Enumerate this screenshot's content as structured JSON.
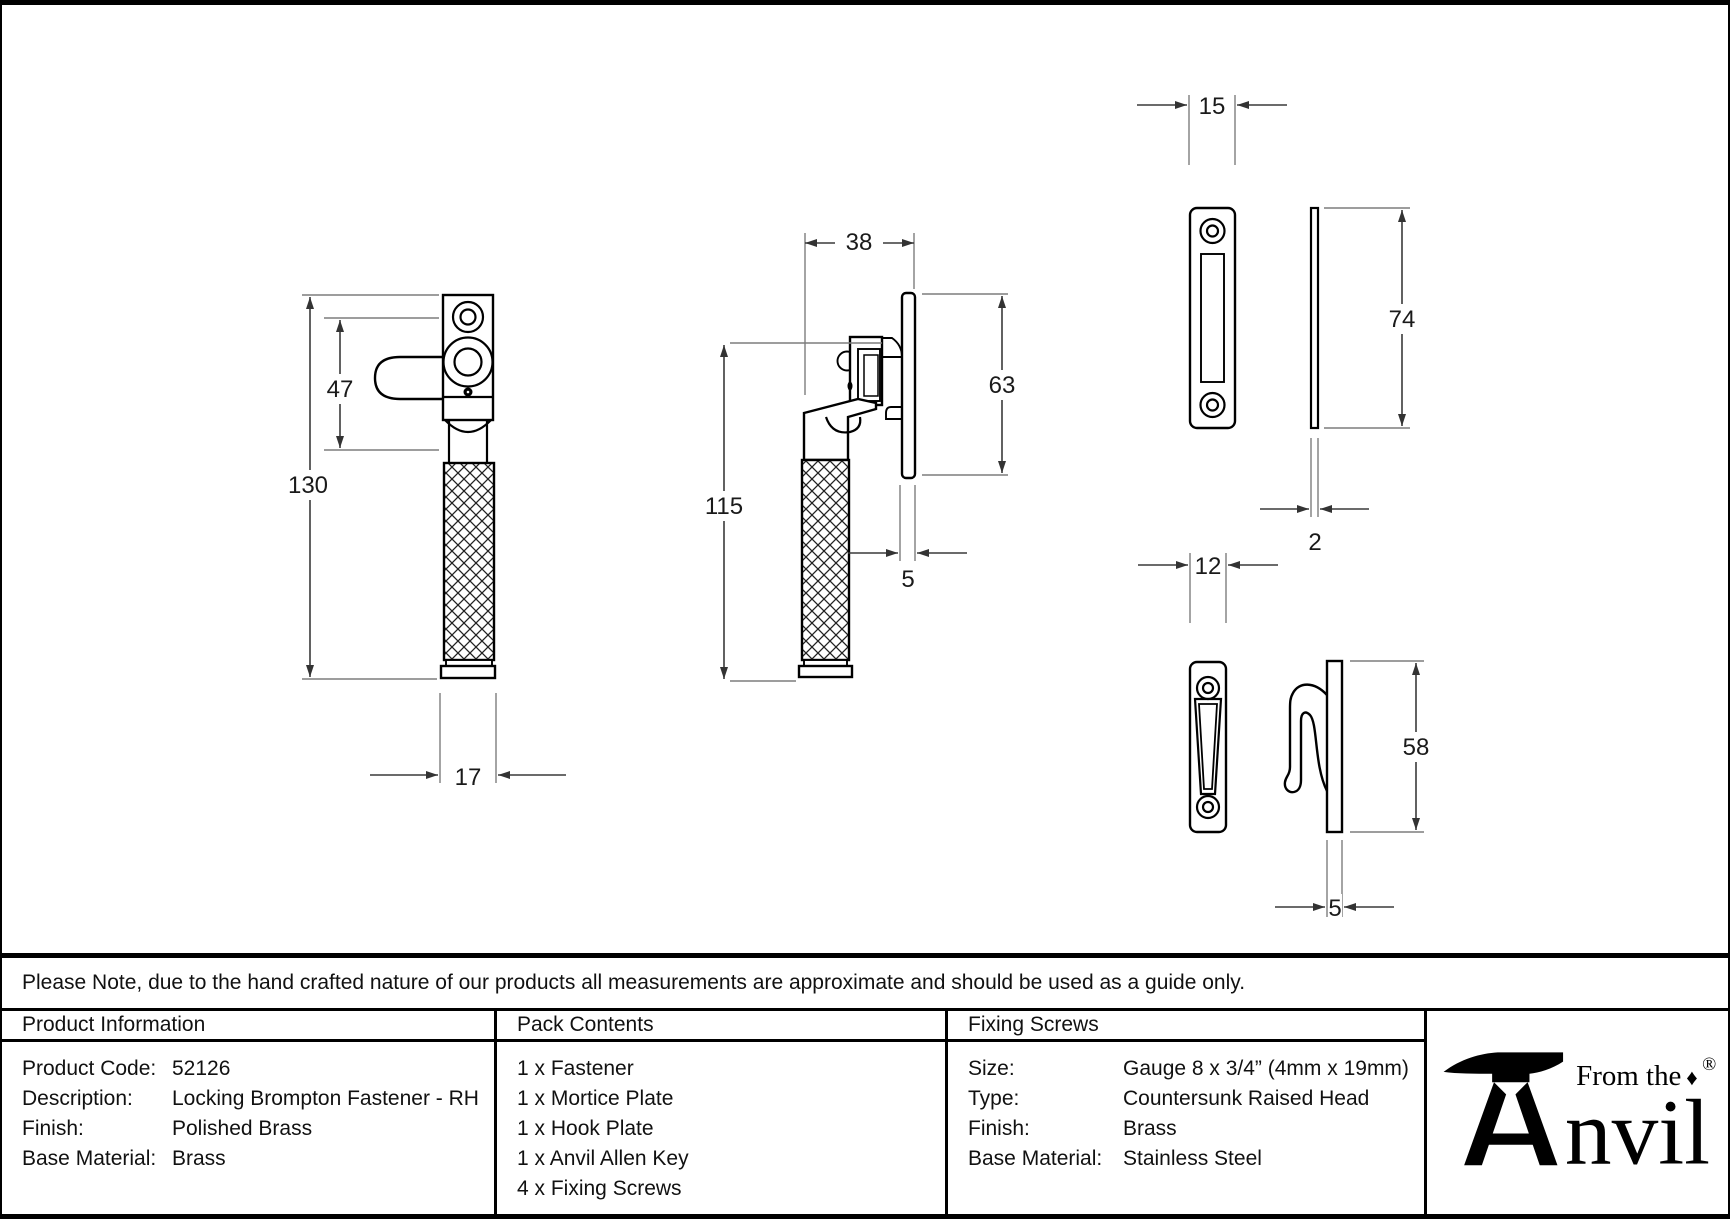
{
  "note": "Please Note, due to the hand crafted nature of our products all measurements are approximate and should be used as a guide only.",
  "dims": {
    "front_overall_height": "130",
    "front_top_section": "47",
    "front_handle_width": "17",
    "side_height": "115",
    "side_depth": "38",
    "side_plate_thickness": "5",
    "side_plate_height": "63",
    "mortice_width": "15",
    "mortice_height": "74",
    "mortice_thickness": "2",
    "hook_width": "12",
    "hook_height": "58",
    "hook_thickness": "5"
  },
  "table": {
    "product_information": {
      "header": "Product Information",
      "rows": [
        {
          "label": "Product Code:",
          "value": "52126"
        },
        {
          "label": "Description:",
          "value": "Locking Brompton Fastener - RH"
        },
        {
          "label": "Finish:",
          "value": "Polished Brass"
        },
        {
          "label": "Base Material:",
          "value": "Brass"
        }
      ]
    },
    "pack_contents": {
      "header": "Pack Contents",
      "items": [
        "1 x Fastener",
        "1 x Mortice Plate",
        "1 x Hook Plate",
        "1 x Anvil Allen Key",
        "4 x Fixing Screws"
      ]
    },
    "fixing_screws": {
      "header": "Fixing Screws",
      "rows": [
        {
          "label": "Size:",
          "value": "Gauge 8 x 3/4” (4mm x 19mm)"
        },
        {
          "label": "Type:",
          "value": "Countersunk Raised Head"
        },
        {
          "label": "Finish:",
          "value": "Brass"
        },
        {
          "label": "Base Material:",
          "value": "Stainless Steel"
        }
      ]
    },
    "logo": {
      "tagline": "From the",
      "wordmark": "Anvil",
      "wordmark_tail": "nvil",
      "diamond": "♦",
      "registered": "®"
    }
  }
}
